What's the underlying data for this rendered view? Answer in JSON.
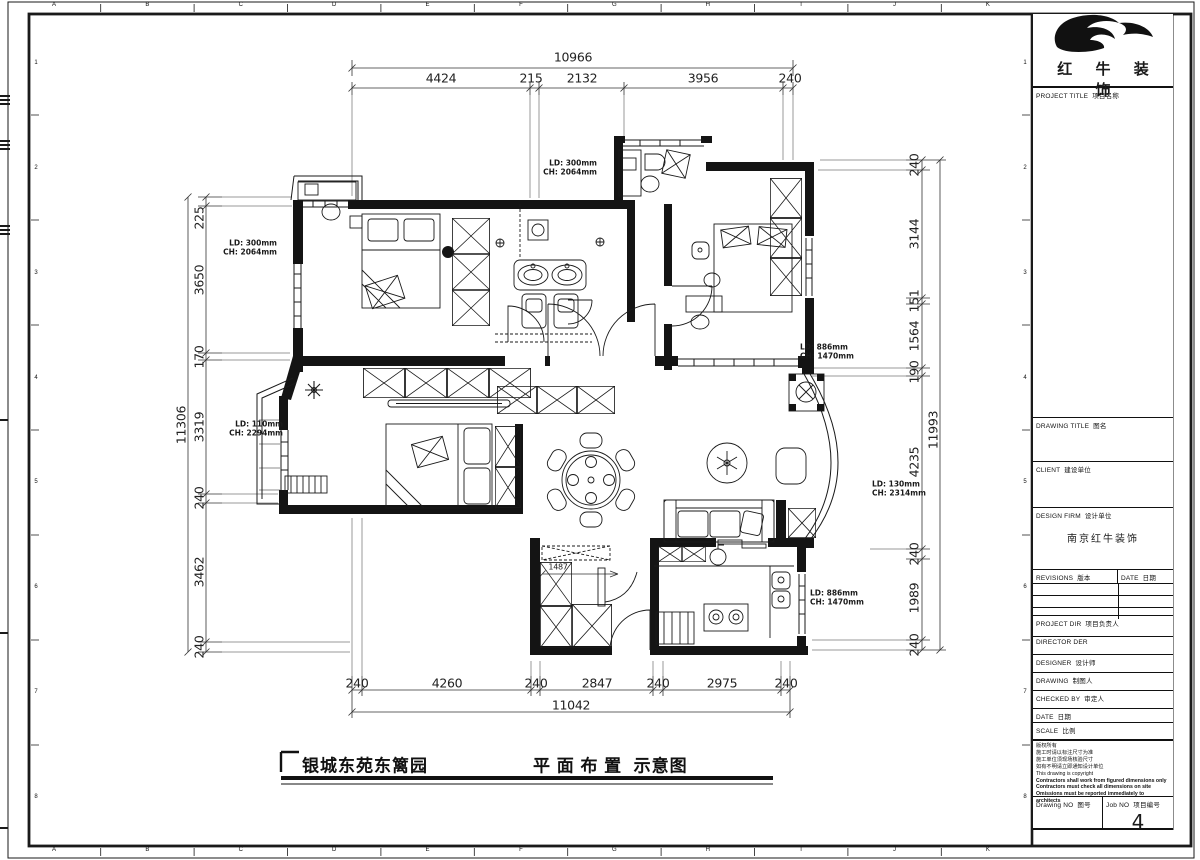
{
  "frame": {
    "letters": [
      "A",
      "B",
      "C",
      "D",
      "E",
      "F",
      "G",
      "H",
      "I",
      "J",
      "K"
    ],
    "numbers": [
      "1",
      "2",
      "3",
      "4",
      "5",
      "6",
      "7",
      "8"
    ]
  },
  "dims": {
    "top": {
      "total": "10966",
      "segments": [
        "4424",
        "215",
        "2132",
        "3956",
        "240"
      ]
    },
    "bottom": {
      "total": "11042",
      "segments": [
        "240",
        "4260",
        "240",
        "2847",
        "240",
        "2975",
        "240"
      ]
    },
    "left": {
      "total": "11306",
      "segments": [
        "225",
        "3650",
        "170",
        "3319",
        "240",
        "3462",
        "240"
      ]
    },
    "right": {
      "total": "11993",
      "segments": [
        "240",
        "3144",
        "151",
        "1564",
        "190",
        "4235",
        "240",
        "1989",
        "240"
      ]
    },
    "inner_closet_width": "1487"
  },
  "window_labels": [
    {
      "ld": "LD: 300mm",
      "ch": "CH: 2064mm"
    },
    {
      "ld": "LD: 300mm",
      "ch": "CH: 2064mm"
    },
    {
      "ld": "LD: 886mm",
      "ch": "CH: 1470mm"
    },
    {
      "ld": "LD: 110mm",
      "ch": "CH: 2294mm"
    },
    {
      "ld": "LD: 130mm",
      "ch": "CH: 2314mm"
    },
    {
      "ld": "LD: 886mm",
      "ch": "CH: 1470mm"
    }
  ],
  "footer": {
    "project_name": "银城东苑东篱园",
    "drawing_name": "平 面 布 置  示意图"
  },
  "titleblock": {
    "brand": "红 牛 装 饰",
    "project_title_label": "PROJECT TITLE  项目名称",
    "drawing_title_label": "DRAWING TITLE  图名",
    "client_label": "CLIENT  建设单位",
    "design_firm_label": "DESIGN FIRM  设计单位",
    "design_firm_name": "南京红牛装饰",
    "revisions_label": "REVISIONS  版本",
    "revisions_date_label": "DATE  日期",
    "project_dir_label": "PROJECT DIR  项目负责人",
    "director_label": "DIRECTOR DER",
    "designer_label": "DESIGNER  设计师",
    "drawing_label": "DRAWING  制图人",
    "checked_by_label": "CHECKED BY  审定人",
    "date_label": "DATE  日期",
    "scale_label": "SCALE  比例",
    "notes": [
      "版权所有",
      "施工时请以标注尺寸为准",
      "施工单位须现场核验尺寸",
      "如有不明请立即通知设计单位",
      "This drawing is copyright",
      "Contractors shall work from figured dimensions only",
      "Contractors must check all dimensions on site",
      "Omissions must be reported immediately to architects"
    ],
    "drawing_no_label": "Drawing NO  图号",
    "job_no_label": "Job NO  项目编号",
    "job_no": "4"
  }
}
